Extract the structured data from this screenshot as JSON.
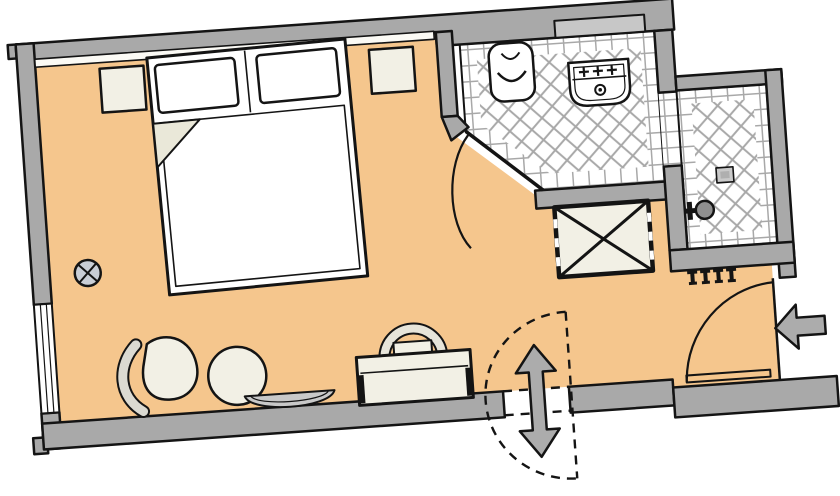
{
  "diagram": {
    "type": "floor-plan",
    "subject": "hotel-guest-room",
    "rooms": [
      {
        "id": "bedroom",
        "label": "bedroom",
        "floor": "parquet-orange"
      },
      {
        "id": "bathroom",
        "label": "bathroom-with-wc-and-washbasin",
        "floor": "tiles"
      },
      {
        "id": "shower-room",
        "label": "shower-room",
        "floor": "tiles"
      },
      {
        "id": "entrance-area",
        "label": "entrance-area",
        "floor": "parquet-orange"
      }
    ],
    "furniture": [
      {
        "id": "double-bed",
        "label": "double bed with two pillows and folded duvet"
      },
      {
        "id": "nightstand-left",
        "label": "nightstand"
      },
      {
        "id": "nightstand-right",
        "label": "nightstand"
      },
      {
        "id": "lounge-chair",
        "label": "curved lounge chair"
      },
      {
        "id": "stool",
        "label": "round stool"
      },
      {
        "id": "side-table",
        "label": "small side table"
      },
      {
        "id": "desk",
        "label": "desk"
      },
      {
        "id": "desk-chair",
        "label": "desk chair"
      },
      {
        "id": "wardrobe",
        "label": "wardrobe (crossed box)"
      },
      {
        "id": "toilet",
        "label": "WC"
      },
      {
        "id": "washbasin",
        "label": "washbasin with taps"
      },
      {
        "id": "shelf",
        "label": "bathroom shelf / counter"
      },
      {
        "id": "shower-drain",
        "label": "shower floor drain"
      },
      {
        "id": "shower-valve",
        "label": "shower fitting"
      },
      {
        "id": "coat-hooks",
        "label": "four wall hooks"
      }
    ],
    "symbols": [
      {
        "id": "entrance-arrow",
        "meaning": "entrance direction into room"
      },
      {
        "id": "entry-door-swing",
        "meaning": "entrance door swing arc"
      },
      {
        "id": "bathroom-door-swing",
        "meaning": "bathroom door swing arc"
      },
      {
        "id": "connecting-door-dashed",
        "meaning": "optional connecting door shown dashed"
      },
      {
        "id": "two-way-arrow",
        "meaning": "passage both directions through connecting door"
      },
      {
        "id": "outlet-symbol",
        "meaning": "circled X service symbol on left wall"
      },
      {
        "id": "window",
        "meaning": "window in left exterior wall"
      }
    ]
  },
  "colors": {
    "background": "#FFFFFF",
    "floor": "#F5C68D",
    "wall": "#A9A9A9",
    "outline": "#141414",
    "tile_bg": "#FFFFFF",
    "tile_line": "#A8A8A8",
    "furniture": "#F2F0E5",
    "bed_white": "#FFFFFF",
    "fold": "#EAE8D9",
    "band": "#DBDAD2",
    "chair_band": "#E7E5DA",
    "table_gray": "#C9C9C9",
    "shelf": "#C7C7C7",
    "metal": "#ACACAC",
    "symbol": "#C9CED6",
    "valve": "#8F8F8F",
    "drain": "#C9C9C9",
    "drain_inner": "#AFAFAF",
    "headboard": "#FBFAF5",
    "window_white": "#FFFFFF"
  }
}
